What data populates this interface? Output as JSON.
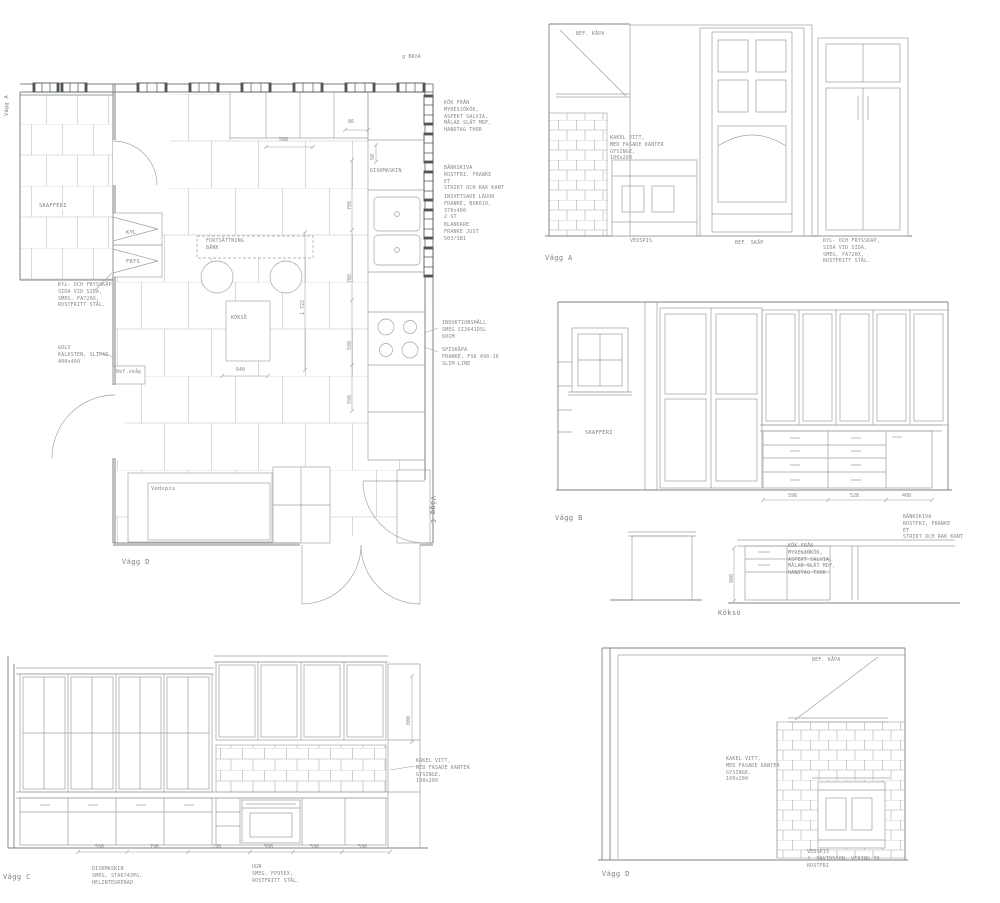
{
  "sheet": {
    "bg": "#ffffff",
    "line_color": "#8b9194",
    "accent_dark": "#50555a",
    "text_color": "#85898c"
  },
  "plan": {
    "wall_left_label": "Vägg A",
    "wall_right_label": "Vägg C",
    "wall_bottom_label": "Vägg D",
    "corner_note": "g BRöA",
    "skafferi": "SKAFFERI",
    "kyl": "KYL",
    "frys": "FRYS",
    "fortsattning_bank": "FORTSÄTTNING\nBÄNK",
    "diskmaskin": "DISKMASKIN",
    "koks_o": "KÖKSÖ",
    "vedspis": "Vedspis",
    "bef_skap": "Bef.skåp",
    "dims": {
      "top_offset": "86",
      "top_width": "598",
      "side_small": "50",
      "right_a": "708",
      "right_b": "708",
      "right_c": "598",
      "right_d": "598",
      "inner_total": "1 722",
      "hob_width": "640"
    },
    "notes": {
      "kyl_frys": "KYL- OCH FRYSSKÅP,\nSIDA VID SIDA,\nSMEG, FA720X,\nROSTFRITT STÅL.",
      "golv": "GOLV\nKALKSTEN, SLIPAD\n400x400",
      "kok": "KÖK FRÅN\nMYRESJÖKÖK,\nASPEKT SALVIA,\nMÅLAD SLÄT MDF,\nHANDTAG THOR",
      "bankskiva": "BÄNKSKIVA\nROSTFRI, FRANKE\nET\nSTRIKT OCH RAK KANT",
      "lador": "INSVETSADE LÅDOR\nFRANKE, BXK610,\n370x400\n2 ST",
      "blandare": "BLANDARE\nFRANKE JUST\n503/SB1",
      "induktion": "INDUKTIONSHÄLL\nSMEG SI2641DSL\n60CM",
      "spiskapa": "SPISKÅPA\nFRANKE, FSK 490-16\nSLIM-LINE"
    }
  },
  "vagg_a": {
    "title": "Vägg A",
    "bef_kapa": "BEF. KÅPA",
    "kakel": "KAKEL VITT,\nMED FASADE KANTER\nGYSINGE,\n100x200",
    "vedspis": "VEDSPIS",
    "bef_skap": "BEF. SKÅP",
    "kyl_frys": "KYL- OCH FRYSSKAP,\nSIDA VID SIDA,\nSMEG, FA720X,\nROSTFRITT STÅL."
  },
  "vagg_b": {
    "title": "Vägg B",
    "skafferi": "SKAFFERI",
    "dims": [
      "598",
      "528",
      "408"
    ]
  },
  "koks_o": {
    "title": "Köksö",
    "height_dim": "900",
    "bankskiva": "BÄNKSKIVA\nROSTFRI, FRANKE\nET\nSTRIKT OCH RAK KANT",
    "kok": "KÖK FRÅN\nMYRESJÖKÖK,\nASPEKT SALVIA,\nMÅLAD SLÄT MDF,\nHANDTAG THOR"
  },
  "vagg_c": {
    "title": "Vägg C",
    "dims": [
      "598",
      "798",
      "798",
      "598",
      "598",
      "598"
    ],
    "height_dim": "800",
    "diskmaskin": "DISKMASKIN\nSMEG, STA6743PG,\nHELINTEGRERAD",
    "ugn": "UGN\nSMEG, FP95EX,\nROSTFRITT STÅL,",
    "kakel": "KAKEL VITT,\nMED FASADE KANTER\nGYSINGE,\n100x200"
  },
  "vagg_d": {
    "title": "Vägg D",
    "bef_kapa": "BEF. KÅPA",
    "kakel": "KAKEL VITT,\nMED FASADE KANTER\nGYSINGE,\n100x200",
    "vedspis": "VEDSPIS\nJ. DAVIDSSON, VIKING 30\nROSTFRI"
  }
}
